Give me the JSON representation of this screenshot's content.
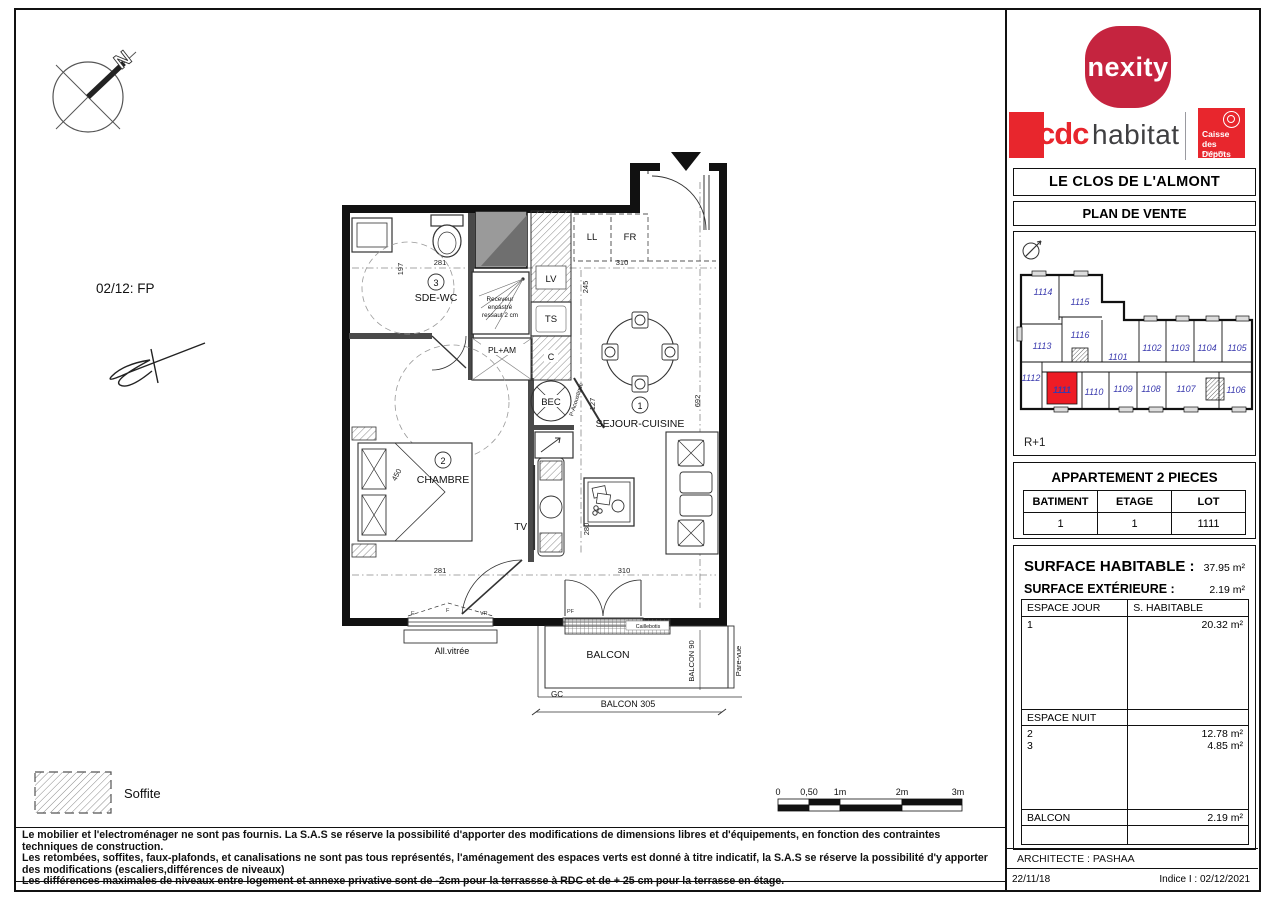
{
  "page_ref": "02/12: FP",
  "compass": {
    "north": "N"
  },
  "plan": {
    "rooms": [
      {
        "num": "3",
        "name": "SDE-WC"
      },
      {
        "num": "2",
        "name": "CHAMBRE"
      },
      {
        "num": "1",
        "name": "SEJOUR-CUISINE"
      }
    ],
    "labels": {
      "ll": "LL",
      "fr": "FR",
      "lv": "LV",
      "ts": "TS",
      "c": "C",
      "bec": "BEC",
      "tv": "TV",
      "pl_am": "PL+AM",
      "p_acoustique": "P-Acoustique",
      "shower_note_1": "Receveur",
      "shower_note_2": "encastré",
      "shower_note_3": "ressaut 2 cm",
      "all_vitree": "All.vitrée",
      "pf": "PF",
      "e": "E",
      "f": "F",
      "vr": "VR",
      "balcon": "BALCON",
      "caillebotis": "Caillebotis",
      "balcon_90": "BALCON 90",
      "pare_vue": "Pare-vue",
      "gc": "GC",
      "balcon_305": "BALCON 305"
    },
    "dims": {
      "d197": "197",
      "d281_top": "281",
      "d310_top": "310",
      "d245": "245",
      "d127": "127",
      "d692": "692",
      "d450": "450",
      "d281_bottom": "281",
      "d280": "280",
      "d310_bottom": "310"
    }
  },
  "legend": {
    "soffite": "Soffite"
  },
  "scale_bar": {
    "ticks": [
      "0",
      "0,50",
      "1m",
      "2m",
      "3m"
    ]
  },
  "disclaimer": {
    "line1": "Le mobilier et l'electroménager ne sont pas fournis. La S.A.S se réserve la possibilité d'apporter des modifications de dimensions libres et d'équipements, en fonction des contraintes techniques de construction.",
    "line2": "Les retombées, soffites, faux-plafonds, et canalisations ne sont pas tous représentés, l'aménagement des espaces verts est donné à titre indicatif, la S.A.S se réserve la possibilité d'y apporter des modifications (escaliers,différences de niveaux)",
    "line3": "Les différences maximales de niveaux entre logement et annexe privative sont de -2cm pour la terrassse à RDC et de + 25 cm pour la terrasse en étage."
  },
  "brand": {
    "nexity": "nexity",
    "cdc": "cdc",
    "habitat": "habitat",
    "caisse_line1": "Caisse",
    "caisse_line2": "des Dépôts",
    "caisse_group": "GROUPE"
  },
  "titles": {
    "project": "LE CLOS DE L'ALMONT",
    "doc_type": "PLAN DE VENTE"
  },
  "site_plan": {
    "floor_label": "R+1",
    "highlighted_unit": "1111",
    "units": [
      "1114",
      "1115",
      "1116",
      "1113",
      "1101",
      "1102",
      "1103",
      "1104",
      "1105",
      "1112",
      "1111",
      "1110",
      "1109",
      "1108",
      "1107",
      "1106"
    ],
    "highlight_color": "#ee1c25",
    "unit_color": "#3a3aae"
  },
  "apartment": {
    "title": "APPARTEMENT 2 PIECES",
    "headers": [
      "BATIMENT",
      "ETAGE",
      "LOT"
    ],
    "values": [
      "1",
      "1",
      "1111"
    ]
  },
  "surfaces": {
    "habitable_label": "SURFACE HABITABLE :",
    "habitable_value": "37.95 m²",
    "exterieure_label": "SURFACE EXTÉRIEURE :",
    "exterieure_value": "2.19 m²",
    "jour_header": "ESPACE JOUR",
    "jour_col": "S. HABITABLE",
    "jour_rows": [
      {
        "num": "1",
        "value": "20.32 m²"
      }
    ],
    "nuit_header": "ESPACE NUIT",
    "nuit_rows": [
      {
        "num": "2",
        "value": "12.78 m²"
      },
      {
        "num": "3",
        "value": "4.85 m²"
      }
    ],
    "balcon_label": "BALCON",
    "balcon_value": "2.19 m²"
  },
  "footer": {
    "architect": "ARCHITECTE : PASHAA",
    "date": "22/11/18",
    "indice": "Indice I : 02/12/2021"
  }
}
